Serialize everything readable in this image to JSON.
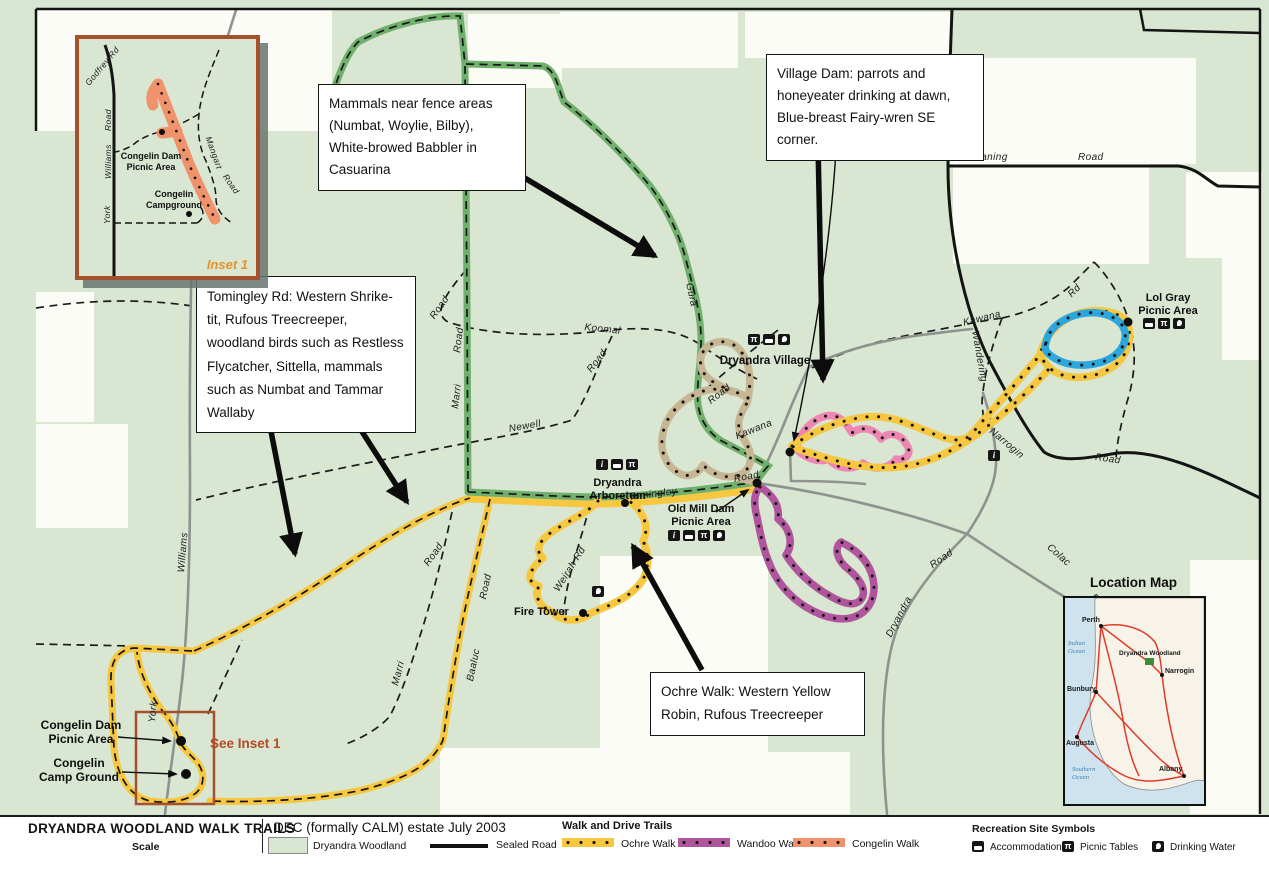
{
  "annotations": {
    "mammals": "Mammals near fence areas (Numbat, Woylie, Bilby), White-browed Babbler in Casuarina",
    "village_dam": "Village Dam: parrots and honeyeater drinking at dawn, Blue-breast Fairy-wren SE corner.",
    "tomingley_rd": "Tomingley Rd: Western Shrike-tit, Rufous Treecreeper, woodland birds such as Restless Flycatcher, Sittella, mammals such as Numbat and Tammar Wallaby",
    "ochre_walk": "Ochre Walk: Western Yellow Robin, Rufous Treecreeper"
  },
  "places": {
    "dryandra_village": "Dryandra Village",
    "dryandra_arboretum": "Dryandra\nArboretum",
    "old_mill_dam": "Old Mill Dam\nPicnic Area",
    "lol_gray": "Lol Gray\nPicnic Area",
    "fire_tower": "Fire Tower",
    "congelin_dam": "Congelin Dam\nPicnic Area",
    "congelin_camp": "Congelin\nCamp Ground",
    "see_inset": "See Inset 1"
  },
  "roads": {
    "yomaning": "Yomaning",
    "yomaning_road": "Road",
    "narrogin": "Narrogin",
    "narrogin_road": "Road",
    "kawana_ne": "Kawana",
    "kawana_ne_rd": "Rd",
    "wandering": "Wandering",
    "kawana": "Kawana",
    "kawana_road": "Road",
    "village_road": "Road",
    "koomal": "Koomal",
    "koomal_road": "Road",
    "road_nw": "Road",
    "newell": "Newell",
    "gura": "Gura",
    "marri_n": "Marri",
    "marri_n_road": "Road",
    "marri_s": "Marri",
    "marri_s_road": "Road",
    "baaluc": "Baaluc",
    "baaluc_road": "Road",
    "weirah": "Weirah Rd",
    "tomingley": "Tomingley",
    "williams": "Williams",
    "york": "York",
    "colac": "Colac",
    "colac_road": "Road",
    "dryandra": "Dryandra",
    "dryandra_road": "Road"
  },
  "inset": {
    "title": "Inset 1",
    "godfrey": "Godfrey Rd",
    "road_word": "Road",
    "williams": "Williams",
    "york": "York",
    "mangart": "Mangart",
    "mangart_road": "Road",
    "congelin_dam": "Congelin Dam\nPicnic Area",
    "congelin_camp": "Congelin\nCampground"
  },
  "legend": {
    "title": "DRYANDRA  WOODLAND WALK TRAILS",
    "scale": "Scale",
    "estate": "DEC (formally CALM) estate July 2003",
    "woodland": "Dryandra Woodland",
    "sealed_road": "Sealed Road",
    "trails_header": "Walk and Drive Trails",
    "trail_ochre": "Ochre Walk",
    "trail_wandoo": "Wandoo Walk",
    "trail_congelin": "Congelin Walk",
    "symbols_header": "Recreation Site Symbols",
    "sym_accommodation": "Accommodation",
    "sym_picnic": "Picnic Tables",
    "sym_water": "Drinking Water"
  },
  "location_map": {
    "title": "Location Map",
    "perth": "Perth",
    "indian_ocean": "Indian\nOcean",
    "dryandra_woodland": "Dryandra Woodland",
    "narrogin": "Narrogin",
    "bunbury": "Bunbury",
    "augusta": "Augusta",
    "southern_ocean": "Southern\nOcean",
    "albany": "Albany"
  },
  "colors": {
    "map-green": "#d9e6d1",
    "white-patch": "#fcfcf6",
    "ochre": "#f6c73f",
    "wandoo": "#b0549e",
    "congelin-trail": "#f0926c",
    "pink-trail": "#ee86b4",
    "blue-trail": "#2ba7dc",
    "tan-trail": "#c7b693",
    "drive-green": "#6fb06c",
    "road-gray": "#8f938f",
    "sealed-black": "#141414",
    "inset-border": "#a5512d",
    "inset-title": "#e2922e",
    "see-inset-text": "#b34a28"
  }
}
